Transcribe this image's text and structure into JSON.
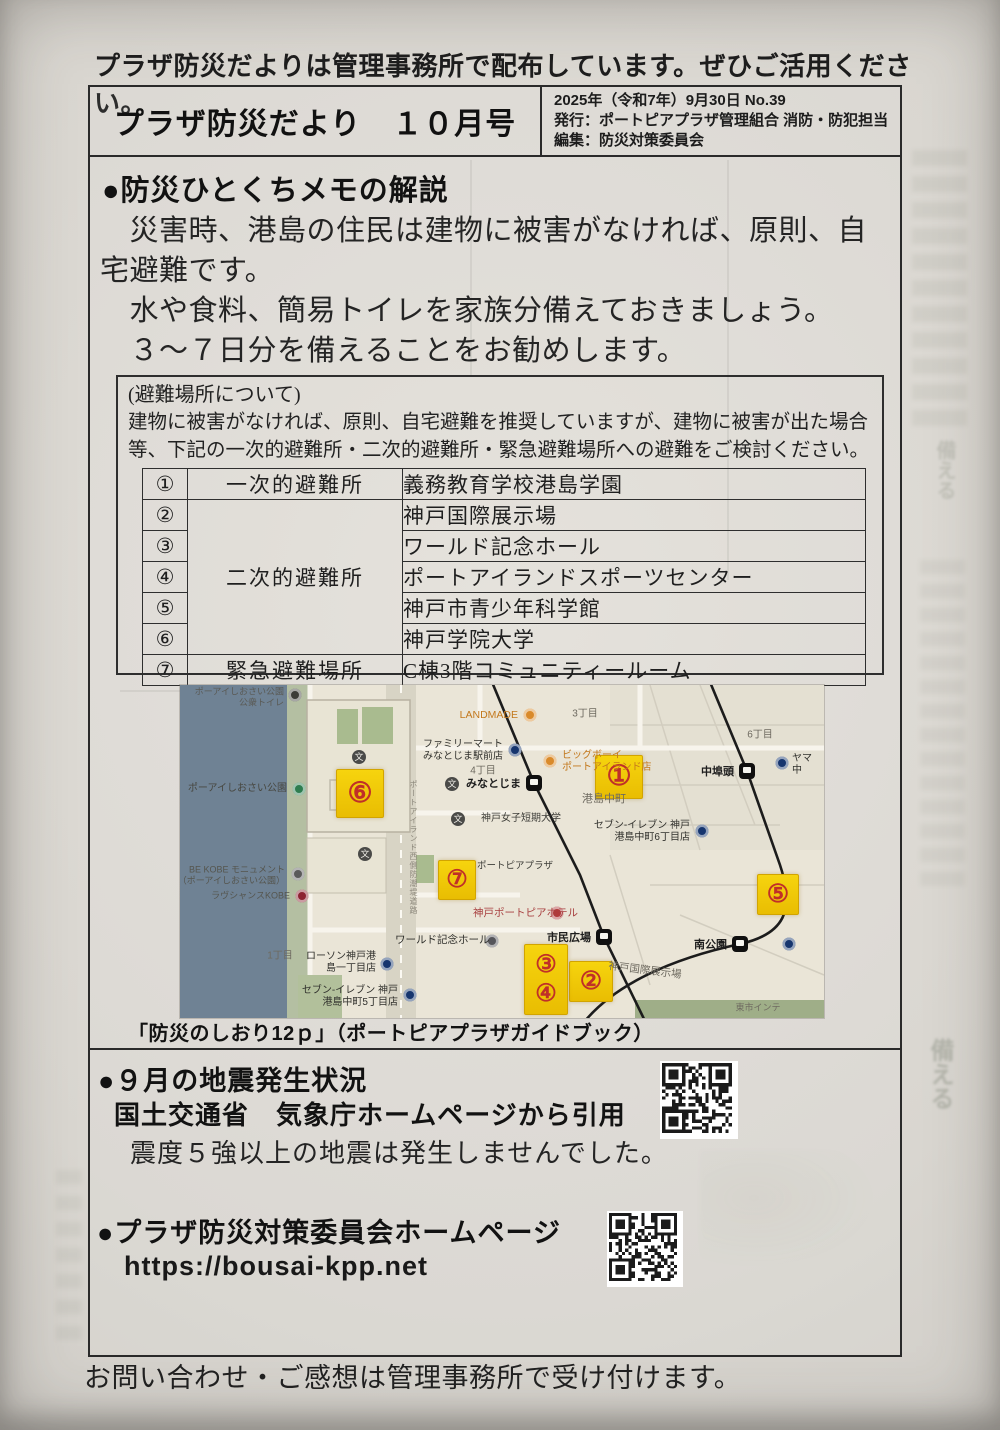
{
  "top_note": "プラザ防災だよりは管理事務所で配布しています。ぜひご活用ください。",
  "header": {
    "title": "プラザ防災だより　１０月号",
    "pub": [
      "2025年（令和7年）9月30日 No.39",
      "発行：ポートピアプラザ管理組合 消防・防犯担当",
      "編集：防災対策委員会"
    ]
  },
  "memo": {
    "heading": "●防災ひとくちメモの解説",
    "lines": [
      "　災害時、港島の住民は建物に被害がなければ、原則、自",
      "宅避難です。",
      "　水や食料、簡易トイレを家族分備えておきましょう。",
      "　３～７日分を備えることをお勧めします。"
    ]
  },
  "shelter": {
    "title": "(避難場所について)",
    "desc1": "建物に被害がなければ、原則、自宅避難を推奨していますが、建物に被害が出た場合",
    "desc2": "等、下記の一次的避難所・二次的避難所・緊急避難場所への避難をご検討ください。",
    "rows": [
      {
        "no": "①",
        "category": "一次的避難所",
        "name": "義務教育学校港島学園"
      },
      {
        "no": "②",
        "category": "二次的避難所",
        "name": "神戸国際展示場"
      },
      {
        "no": "③",
        "category": "",
        "name": "ワールド記念ホール"
      },
      {
        "no": "④",
        "category": "",
        "name": "ポートアイランドスポーツセンター"
      },
      {
        "no": "⑤",
        "category": "",
        "name": "神戸市青少年科学館"
      },
      {
        "no": "⑥",
        "category": "",
        "name": "神戸学院大学"
      },
      {
        "no": "⑦",
        "category": "緊急避難場所",
        "name": "C棟3階コミュニティールーム"
      }
    ]
  },
  "map": {
    "caption": "「防災のしおり12ｐ」（ポートピアプラザガイドブック）",
    "markers": [
      {
        "no": "①",
        "x": 415,
        "y": 70,
        "w": 46,
        "h": 42,
        "fs": 28
      },
      {
        "no": "②",
        "x": 389,
        "y": 276,
        "w": 42,
        "h": 39,
        "fs": 25
      },
      {
        "no": "③\n④",
        "x": 344,
        "y": 259,
        "w": 42,
        "h": 69,
        "fs": 24
      },
      {
        "no": "⑤",
        "x": 577,
        "y": 189,
        "w": 40,
        "h": 39,
        "fs": 25
      },
      {
        "no": "⑥",
        "x": 156,
        "y": 84,
        "w": 46,
        "h": 47,
        "fs": 28
      },
      {
        "no": "⑦",
        "x": 258,
        "y": 175,
        "w": 36,
        "h": 38,
        "fs": 24
      }
    ],
    "stations": [
      {
        "label": "みなとじま",
        "x": 354,
        "y": 98
      },
      {
        "label": "市民広場",
        "x": 424,
        "y": 252
      },
      {
        "label": "南公園",
        "x": 560,
        "y": 259
      },
      {
        "label": "中埠頭",
        "x": 567,
        "y": 86
      }
    ],
    "pois": [
      {
        "text": "ポーアイしおさい公園\n公衆トイレ",
        "x": 104,
        "y": 12,
        "align": "right",
        "size": 9,
        "color": "#5a5a55"
      },
      {
        "text": "ポーアイしおさい公園",
        "x": 107,
        "y": 104,
        "align": "right",
        "size": 10,
        "color": "#474740"
      },
      {
        "text": "BE KOBE モニュメント\n（ポーアイしおさい公園）",
        "x": 105,
        "y": 190,
        "align": "right",
        "size": 9,
        "color": "#55554e"
      },
      {
        "text": "ラヴシャンスKOBE",
        "x": 110,
        "y": 211,
        "align": "right",
        "size": 9,
        "color": "#55554e"
      },
      {
        "text": "LANDMADE",
        "x": 338,
        "y": 30,
        "align": "right",
        "size": 10.5,
        "color": "#c3781c"
      },
      {
        "text": "ファミリーマート\nみなとじま駅前店",
        "x": 323,
        "y": 66,
        "align": "right",
        "size": 10,
        "color": "#30302c"
      },
      {
        "text": "ビッグボーイ\nポートアイランド店",
        "x": 382,
        "y": 77,
        "align": "left",
        "size": 10,
        "color": "#c3781c"
      },
      {
        "text": "神戸女子短期大学",
        "x": 301,
        "y": 134,
        "align": "left",
        "size": 10,
        "color": "#3d3d38"
      },
      {
        "text": "セブン-イレブン 神戸\n港島中町6丁目店",
        "x": 510,
        "y": 147,
        "align": "right",
        "size": 10,
        "color": "#30302c"
      },
      {
        "text": "ヤマ\n中",
        "x": 612,
        "y": 80,
        "align": "left",
        "size": 10,
        "color": "#30302c"
      },
      {
        "text": "ポートピアプラザ",
        "x": 297,
        "y": 181,
        "align": "left",
        "size": 9.5,
        "color": "#3d3d38"
      },
      {
        "text": "神戸ポートピアホテル",
        "x": 293,
        "y": 228,
        "align": "left",
        "size": 10.5,
        "color": "#a84040"
      },
      {
        "text": "ワールド記念ホール",
        "x": 215,
        "y": 255,
        "align": "left",
        "size": 10.5,
        "color": "#30302c"
      },
      {
        "text": "ローソン神戸港\n島一丁目店",
        "x": 196,
        "y": 278,
        "align": "right",
        "size": 10,
        "color": "#30302c"
      },
      {
        "text": "セブン-イレブン 神戸\n港島中町5丁目店",
        "x": 218,
        "y": 312,
        "align": "right",
        "size": 10,
        "color": "#30302c"
      }
    ],
    "dots": [
      {
        "x": 115,
        "y": 10,
        "c": "#3c3c38"
      },
      {
        "x": 119,
        "y": 104,
        "c": "#2e7d4f"
      },
      {
        "x": 118,
        "y": 189,
        "c": "#5a5a5a"
      },
      {
        "x": 122,
        "y": 211,
        "c": "#8c2332"
      },
      {
        "x": 350,
        "y": 30,
        "c": "#d98a2b"
      },
      {
        "x": 335,
        "y": 65,
        "c": "#16356e"
      },
      {
        "x": 370,
        "y": 76,
        "c": "#d98a2b"
      },
      {
        "x": 522,
        "y": 146,
        "c": "#16356e"
      },
      {
        "x": 602,
        "y": 78,
        "c": "#16356e"
      },
      {
        "x": 377,
        "y": 228,
        "c": "#b03a3a"
      },
      {
        "x": 312,
        "y": 256,
        "c": "#55555a"
      },
      {
        "x": 207,
        "y": 279,
        "c": "#16356e"
      },
      {
        "x": 230,
        "y": 310,
        "c": "#16356e"
      },
      {
        "x": 609,
        "y": 259,
        "c": "#16356e"
      }
    ],
    "schools": [
      {
        "x": 179,
        "y": 72
      },
      {
        "x": 185,
        "y": 169
      },
      {
        "x": 278,
        "y": 134
      },
      {
        "x": 272,
        "y": 99
      }
    ],
    "areas": [
      {
        "text": "3丁目",
        "x": 405,
        "y": 27,
        "size": 10
      },
      {
        "text": "4丁目",
        "x": 303,
        "y": 84,
        "size": 10
      },
      {
        "text": "6丁目",
        "x": 580,
        "y": 48,
        "size": 10
      },
      {
        "text": "1丁目",
        "x": 100,
        "y": 269,
        "size": 10
      },
      {
        "text": "港島中町",
        "x": 424,
        "y": 113,
        "size": 11
      },
      {
        "text": "神戸国際展示場",
        "x": 465,
        "y": 285,
        "size": 10.5,
        "rotate": 7
      },
      {
        "text": "東市インテ",
        "x": 578,
        "y": 322,
        "size": 9
      }
    ],
    "road_label": "ポートアイランド西側防潮堤道路"
  },
  "earthquake": {
    "heading": "●９月の地震発生状況",
    "source": "国土交通省　気象庁ホームページから引用",
    "result": "震度５強以上の地震は発生しませんでした。"
  },
  "homepage": {
    "heading": "●プラザ防災対策委員会ホームページ",
    "url": "https://bousai-kpp.net"
  },
  "footer": "お問い合わせ・ご感想は管理事務所で受け付けます。",
  "ghost": {
    "text": "備える"
  },
  "colors": {
    "paper": "#dcd9d3",
    "ink": "#2a2a2a",
    "marker_yellow": "#f2cb05",
    "marker_number_red": "#c03028",
    "map_water": "#6f8294",
    "map_land": "#eae5d7",
    "map_green": "#a9bb8f"
  }
}
